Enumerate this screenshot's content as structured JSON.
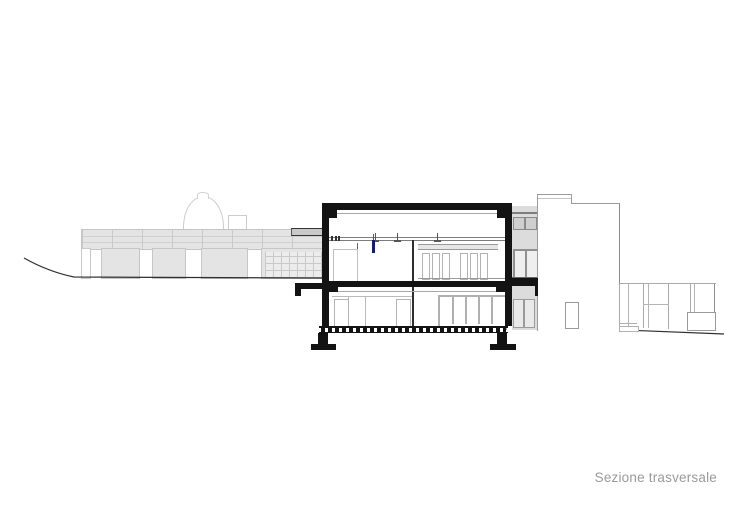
{
  "caption": {
    "label": "Sezione trasversale"
  },
  "colors": {
    "poche": "#131313",
    "light_fill": "#e4e4e4",
    "grid_line": "#c9c9c9",
    "outline": "#9b9b9b",
    "caption": "#9a9a9a",
    "blue": "#1b1b6e",
    "terrain": "#2f2f2f",
    "bay_fill": "#dcdcdc",
    "win_fill": "#cfcfcf"
  }
}
